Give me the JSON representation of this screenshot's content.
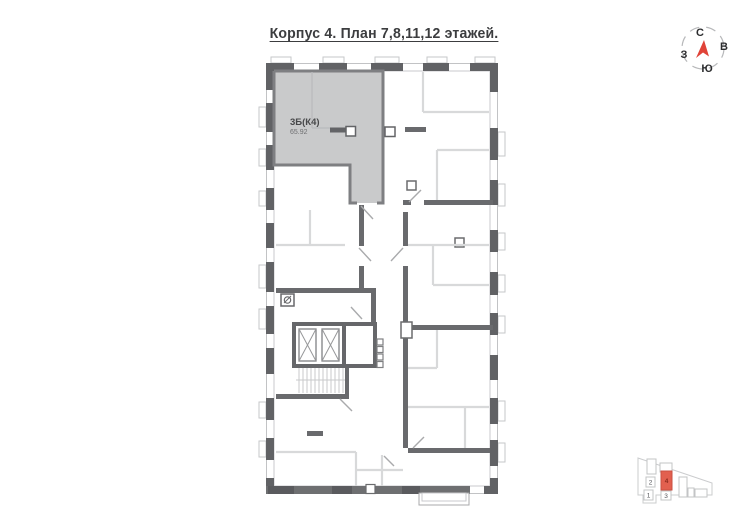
{
  "title": "Корпус 4. План 7,8,11,12 этажей.",
  "apartment": {
    "name": "3Б(К4)",
    "area": "65.92"
  },
  "compass": {
    "north": "С",
    "east": "В",
    "south": "Ю",
    "west": "З"
  },
  "minimap": {
    "b1": "1",
    "b2": "2",
    "b3": "3",
    "b4": "4"
  },
  "colors": {
    "highlight_fill": "#c9cacb",
    "highlight_border": "#7e7f82",
    "compass_north": "#2f6bd8",
    "arrow_red": "#e04338",
    "minimap_highlight": "#e2604f"
  }
}
